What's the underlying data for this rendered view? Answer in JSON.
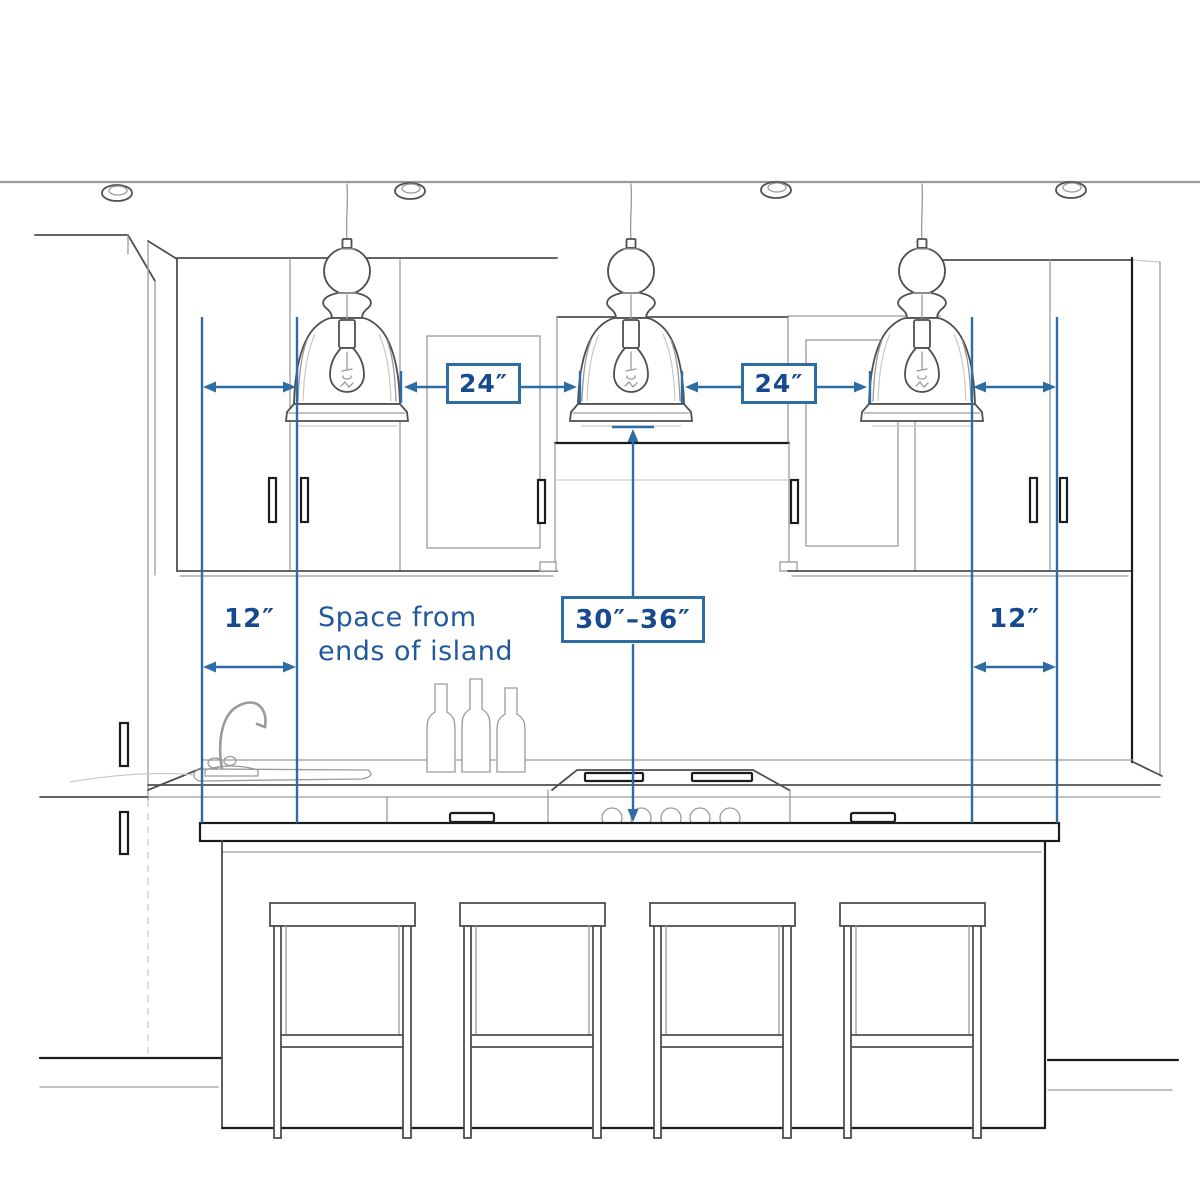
{
  "diagram": {
    "title_hidden": "",
    "type": "kitchen-island-pendant-spacing-guide",
    "colors": {
      "dimension_blue": "#2e6da4",
      "label_navy": "#17498f",
      "note_blue": "#205a9d",
      "sketch_gray": "#4f4f4f",
      "background": "#ffffff"
    },
    "dimensions": {
      "pendant_gap_left": {
        "label": "24″"
      },
      "pendant_gap_right": {
        "label": "24″"
      },
      "pendant_height_range": {
        "label": "30″–36″"
      },
      "island_end_offset_left": {
        "label": "12″"
      },
      "island_end_offset_right": {
        "label": "12″"
      },
      "note": {
        "line1": "Space from",
        "line2": "ends of island"
      }
    },
    "scene": {
      "pendant_count": 3,
      "bar_stool_count": 4,
      "recessed_ceiling_light_count": 4,
      "wine_bottle_count": 3,
      "cooktop_knob_count": 5
    }
  }
}
